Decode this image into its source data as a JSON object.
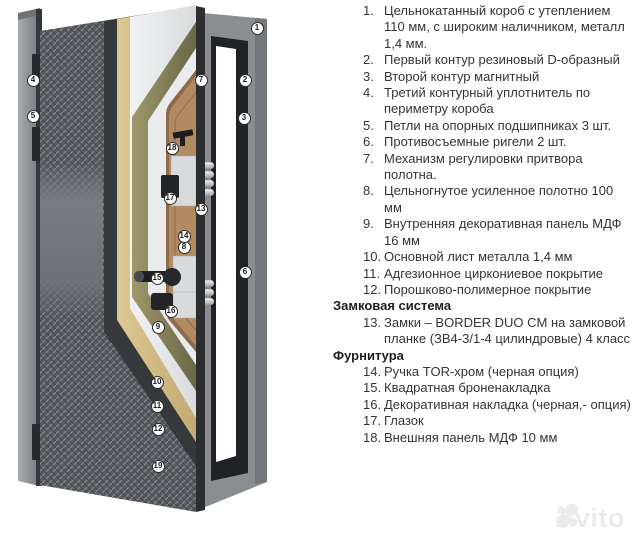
{
  "diagram": {
    "description": "cutaway-3d-render-of-steel-entrance-door-with-frame",
    "markers": [
      {
        "label": "1",
        "x": 257,
        "y": 28
      },
      {
        "label": "2",
        "x": 245,
        "y": 80
      },
      {
        "label": "3",
        "x": 244,
        "y": 118
      },
      {
        "label": "4",
        "x": 33,
        "y": 80
      },
      {
        "label": "5",
        "x": 33,
        "y": 116
      },
      {
        "label": "6",
        "x": 245,
        "y": 272
      },
      {
        "label": "7",
        "x": 201,
        "y": 80
      },
      {
        "label": "8",
        "x": 184,
        "y": 247
      },
      {
        "label": "9",
        "x": 158,
        "y": 327
      },
      {
        "label": "10",
        "x": 157,
        "y": 382
      },
      {
        "label": "11",
        "x": 157,
        "y": 406
      },
      {
        "label": "12",
        "x": 158,
        "y": 429
      },
      {
        "label": "13",
        "x": 201,
        "y": 209
      },
      {
        "label": "14",
        "x": 184,
        "y": 236
      },
      {
        "label": "15",
        "x": 157,
        "y": 278
      },
      {
        "label": "16",
        "x": 171,
        "y": 311
      },
      {
        "label": "17",
        "x": 170,
        "y": 198
      },
      {
        "label": "18",
        "x": 172,
        "y": 148
      },
      {
        "label": "19",
        "x": 158,
        "y": 466
      }
    ]
  },
  "legend": {
    "entries": [
      {
        "type": "item",
        "num": "1.",
        "text": "Цельнокатанный короб с утеплением 110 мм, с широким наличником, металл 1,4 мм."
      },
      {
        "type": "item",
        "num": "2.",
        "text": "Первый контур резиновый D-образный"
      },
      {
        "type": "item",
        "num": "3.",
        "text": "Второй контур магнитный"
      },
      {
        "type": "item",
        "num": "4.",
        "text": "Третий контурный уплотнитель по периметру короба"
      },
      {
        "type": "item",
        "num": "5.",
        "text": "Петли на опорных подшипниках 3 шт."
      },
      {
        "type": "item",
        "num": "6.",
        "text": "Противосъемные ригели 2 шт."
      },
      {
        "type": "item",
        "num": "7.",
        "text": "Механизм регулировки притвора полотна."
      },
      {
        "type": "item",
        "num": "8.",
        "text": "Цельногнутое усиленное полотно 100 мм"
      },
      {
        "type": "item",
        "num": "9.",
        "text": "Внутренняя декоративная панель МДФ 16 мм"
      },
      {
        "type": "item",
        "num": "10.",
        "text": "Основной лист металла 1,4 мм"
      },
      {
        "type": "item",
        "num": "11.",
        "text": "Адгезионное циркониевое покрытие"
      },
      {
        "type": "item",
        "num": "12.",
        "text": "Порошково-полимерное покрытие"
      },
      {
        "type": "heading",
        "text": "Замковая система"
      },
      {
        "type": "item",
        "num": "13.",
        "text": "Замки – BORDER DUO CM на замковой планке (ЗВ4-3/1-4 цилиндровые) 4 класс"
      },
      {
        "type": "heading",
        "text": "Фурнитура"
      },
      {
        "type": "item",
        "num": "14.",
        "text": "Ручка TOR-хром (черная опция)"
      },
      {
        "type": "item",
        "num": "15.",
        "text": "Квадратная броненакладка"
      },
      {
        "type": "item",
        "num": "16.",
        "text": "Декоративная накладка (черная,- опция)"
      },
      {
        "type": "item",
        "num": "17.",
        "text": "Глазок"
      },
      {
        "type": "item",
        "num": "18.",
        "text": "Внешняя панель МДФ 10 мм"
      }
    ]
  },
  "watermark": {
    "text": "Avito"
  },
  "colors": {
    "texture_panel": "#575b5f",
    "metal_layer": "#36383b",
    "mdf_outer_tan": "#d3bc85",
    "steel_white": "#eceeef",
    "insulation_olive": "#948f66",
    "inner_panel_wood": "#b28a62",
    "frame_gray": "#8b8e91",
    "seal_black": "#1c1e20",
    "text": "#353535"
  }
}
